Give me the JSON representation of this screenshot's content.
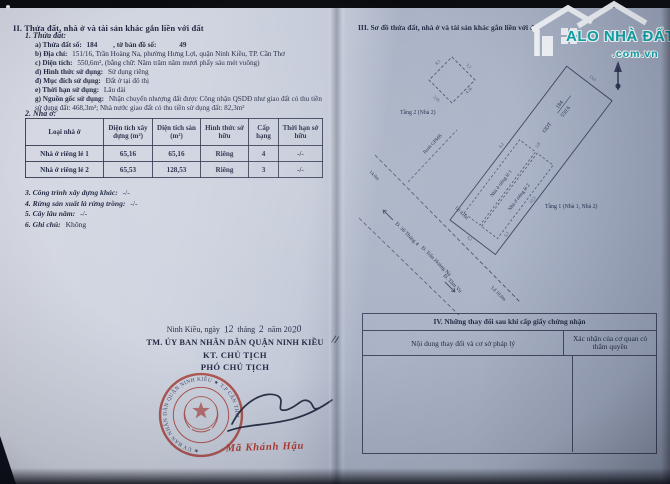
{
  "left_page": {
    "section_II": {
      "heading": "II. Thửa đất, nhà ở và tài sản khác gắn liền với đất",
      "sub1_heading": "1. Thửa đất:",
      "items": [
        {
          "label": "a) Thửa đất số:",
          "value": "184",
          "label2": ", tờ bản đồ số:",
          "value2": "49"
        },
        {
          "label": "b) Địa chỉ:",
          "value": "151/16, Trần Hoàng Na, phường Hưng Lợi, quận Ninh Kiều, TP. Cần Thơ"
        },
        {
          "label": "c) Diện tích:",
          "value": "550,6m², (bằng chữ: Năm trăm năm mươi phẩy sáu mét vuông)"
        },
        {
          "label": "d) Hình thức sử dụng:",
          "value": "Sử dụng riêng"
        },
        {
          "label": "đ) Mục đích sử dụng:",
          "value": "Đất ở tại đô thị"
        },
        {
          "label": "e) Thời hạn sử dụng:",
          "value": "Lâu dài"
        },
        {
          "label": "g) Nguồn gốc sử dụng:",
          "value": "Nhận chuyển nhượng đất được Công nhận QSDĐ như giao đất có thu tiền sử dụng đất: 468,3m²; Nhà nước giao đất có thu tiền sử dụng đất: 82,3m²"
        }
      ],
      "sub2_heading": "2. Nhà ở:",
      "house_table": {
        "headers": [
          "Loại nhà ở",
          "Diện tích xây dựng (m²)",
          "Diện tích sàn (m²)",
          "Hình thức sở hữu",
          "Cấp hạng",
          "Thời hạn sở hữu"
        ],
        "rows": [
          [
            "Nhà ở riêng lẻ 1",
            "65,16",
            "65,16",
            "Riêng",
            "4",
            "-/-"
          ],
          [
            "Nhà ở riêng lẻ 2",
            "65,53",
            "128,53",
            "Riêng",
            "3",
            "-/-"
          ]
        ]
      },
      "other_items": [
        {
          "label": "3. Công trình xây dựng khác:",
          "value": "-/-"
        },
        {
          "label": "4. Rừng sản xuất là rừng trồng:",
          "value": "-/-"
        },
        {
          "label": "5. Cây lâu năm:",
          "value": "-/-"
        },
        {
          "label": "6. Ghi chú:",
          "value": "Không"
        }
      ]
    },
    "signature": {
      "place_date": {
        "p1": "Ninh Kiều, ngày",
        "day": "12",
        "p2": "tháng",
        "month": "2",
        "p3": "năm 20",
        "year": "20"
      },
      "authority": "TM. ỦY BAN NHÂN DÂN QUẬN NINH KIỀU",
      "title1": "KT. CHỦ TỊCH",
      "title2": "PHÓ CHỦ TỊCH",
      "ink_mark": "//",
      "signer": "Mã Khánh Hậu",
      "stamp": {
        "ring_text": "★ ỦY BAN NHÂN DÂN QUẬN NINH KIỀU ★ T.P CẦN THƠ"
      }
    }
  },
  "right_page": {
    "section_III_heading": "III. Sơ đồ thửa đất, nhà ở và tài sản khác gắn liền với đất",
    "sketch": {
      "parcel_code": "ODT",
      "parcel_number": "184",
      "parcel_area": "550.6",
      "floor2_label": "Tầng 2 (Nhà 2)",
      "floor1_label": "Tầng 1 (Nhà 1, Nhà 2)",
      "house1_label": "Nhà ở riêng lẻ 1",
      "house2_label": "Nhà ở riêng lẻ 2",
      "boundary_label": "Ranh GPMB",
      "road_width_near": "Lộ 4,0m",
      "road_width_far": "Lộ 10,0m",
      "frontage_dim": "14,0m",
      "roads": [
        "Đ. 30 Tháng 4",
        "Đ. Trần Hoàng Na",
        "Đ. Tầm Vu"
      ],
      "dims": [
        "8,1",
        "3,2",
        "2,05",
        "4,26",
        "6,1",
        "13,6",
        "4,2",
        "5,5",
        "10,3",
        "2,8"
      ]
    },
    "section_IV": {
      "title": "IV. Những thay đổi sau khi cấp giấy chứng nhận",
      "col_left": "Nội dung thay đổi và cơ sở pháp lý",
      "col_right": "Xác nhận của cơ quan có thẩm quyền"
    }
  },
  "watermark": {
    "brand": "ALO NHÀ ĐẤT",
    "domain": ".com.vn",
    "teal": "#0da9ae"
  }
}
